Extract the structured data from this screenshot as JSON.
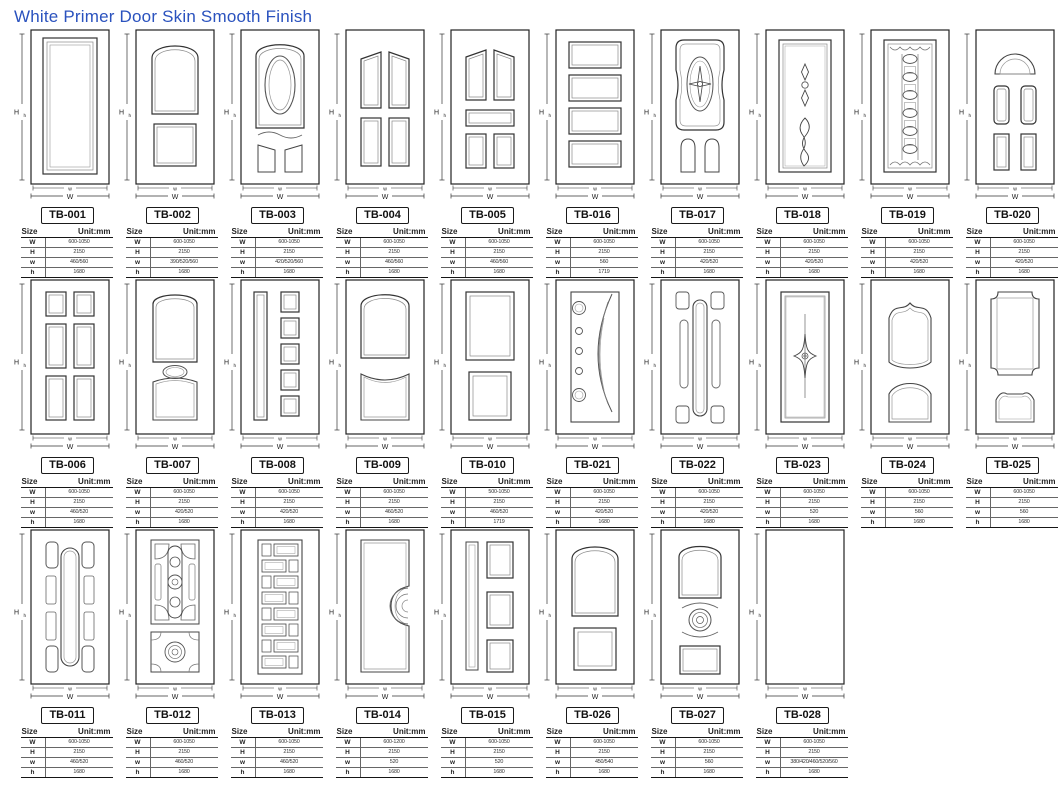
{
  "page": {
    "title": "White Primer Door Skin Smooth Finish",
    "title_color": "#2a52be",
    "line_color": "#333333"
  },
  "dim_labels": {
    "outer_height": "H",
    "inner_height": "h",
    "outer_width": "W",
    "inner_width": "w"
  },
  "table": {
    "size_label": "Size",
    "unit_label": "Unit:mm",
    "row_labels": [
      "W",
      "H",
      "w",
      "h"
    ]
  },
  "rows": [
    [
      {
        "code": "TB-001",
        "design": "single-panel",
        "sizes": {
          "W": "600-1050",
          "H": "2150",
          "w": "460/560",
          "h": "1680"
        }
      },
      {
        "code": "TB-002",
        "design": "arch-top-2-panel",
        "sizes": {
          "W": "600-1050",
          "H": "2150",
          "w": "390/520/560",
          "h": "1680"
        }
      },
      {
        "code": "TB-003",
        "design": "oval-arch",
        "sizes": {
          "W": "600-1050",
          "H": "2150",
          "w": "420/520/560",
          "h": "1680"
        }
      },
      {
        "code": "TB-004",
        "design": "four-panel",
        "sizes": {
          "W": "600-1050",
          "H": "2150",
          "w": "460/560",
          "h": "1680"
        }
      },
      {
        "code": "TB-005",
        "design": "five-panel",
        "sizes": {
          "W": "600-1050",
          "H": "2150",
          "w": "460/560",
          "h": "1680"
        }
      },
      {
        "code": "TB-016",
        "design": "four-horizontal",
        "sizes": {
          "W": "600-1050",
          "H": "2150",
          "w": "560",
          "h": "1719"
        }
      },
      {
        "code": "TB-017",
        "design": "oval-medallion",
        "sizes": {
          "W": "600-1050",
          "H": "2150",
          "w": "420/520",
          "h": "1680"
        }
      },
      {
        "code": "TB-018",
        "design": "twist-ornament",
        "sizes": {
          "W": "600-1050",
          "H": "2150",
          "w": "420/520",
          "h": "1680"
        }
      },
      {
        "code": "TB-019",
        "design": "bead-column",
        "sizes": {
          "W": "600-1050",
          "H": "2150",
          "w": "420/520",
          "h": "1680"
        }
      },
      {
        "code": "TB-020",
        "design": "fan-top-4-panel",
        "sizes": {
          "W": "600-1050",
          "H": "2150",
          "w": "420/520",
          "h": "1680"
        }
      }
    ],
    [
      {
        "code": "TB-006",
        "design": "six-panel",
        "sizes": {
          "W": "600-1050",
          "H": "2150",
          "w": "460/520",
          "h": "1680"
        }
      },
      {
        "code": "TB-007",
        "design": "arch-oval-3",
        "sizes": {
          "W": "600-1050",
          "H": "2150",
          "w": "420/520",
          "h": "1680"
        }
      },
      {
        "code": "TB-008",
        "design": "five-squares-side",
        "sizes": {
          "W": "600-1050",
          "H": "2150",
          "w": "420/520",
          "h": "1680"
        }
      },
      {
        "code": "TB-009",
        "design": "arch-concave",
        "sizes": {
          "W": "600-1050",
          "H": "2150",
          "w": "460/520",
          "h": "1680"
        }
      },
      {
        "code": "TB-010",
        "design": "two-panel-plain",
        "sizes": {
          "W": "500-1050",
          "H": "2150",
          "w": "460/520",
          "h": "1719"
        }
      },
      {
        "code": "TB-021",
        "design": "arc-circles",
        "sizes": {
          "W": "600-1050",
          "H": "2150",
          "w": "420/520",
          "h": "1680"
        }
      },
      {
        "code": "TB-022",
        "design": "capsule-corners",
        "sizes": {
          "W": "600-1050",
          "H": "2150",
          "w": "420/520",
          "h": "1680"
        }
      },
      {
        "code": "TB-023",
        "design": "star-panel",
        "sizes": {
          "W": "600-1050",
          "H": "2150",
          "w": "520",
          "h": "1680"
        }
      },
      {
        "code": "TB-024",
        "design": "ogee-2-panel",
        "sizes": {
          "W": "600-1050",
          "H": "2150",
          "w": "560",
          "h": "1680"
        }
      },
      {
        "code": "TB-025",
        "design": "ornate-2-panel",
        "sizes": {
          "W": "600-1050",
          "H": "2150",
          "w": "560",
          "h": "1680"
        }
      }
    ],
    [
      {
        "code": "TB-011",
        "design": "capsule-surround",
        "sizes": {
          "W": "600-1050",
          "H": "2150",
          "w": "460/520",
          "h": "1680"
        }
      },
      {
        "code": "TB-012",
        "design": "geometric-medallion",
        "sizes": {
          "W": "600-1050",
          "H": "2150",
          "w": "460/520",
          "h": "1680"
        }
      },
      {
        "code": "TB-013",
        "design": "brick-column",
        "sizes": {
          "W": "600-1050",
          "H": "2150",
          "w": "460/520",
          "h": "1680"
        }
      },
      {
        "code": "TB-014",
        "design": "side-fan",
        "sizes": {
          "W": "600-1200",
          "H": "2150",
          "w": "520",
          "h": "1680"
        }
      },
      {
        "code": "TB-015",
        "design": "three-right-panel",
        "sizes": {
          "W": "600-1050",
          "H": "2150",
          "w": "520",
          "h": "1680"
        }
      },
      {
        "code": "TB-026",
        "design": "arch-square",
        "sizes": {
          "W": "600-1050",
          "H": "2150",
          "w": "450/540",
          "h": "1680"
        }
      },
      {
        "code": "TB-027",
        "design": "circle-medallion",
        "sizes": {
          "W": "600-1050",
          "H": "2150",
          "w": "560",
          "h": "1680"
        }
      },
      {
        "code": "TB-028",
        "design": "flush",
        "sizes": {
          "W": "600-1050",
          "H": "2150",
          "w": "380/420/460/520/560",
          "h": "1680"
        }
      }
    ]
  ]
}
